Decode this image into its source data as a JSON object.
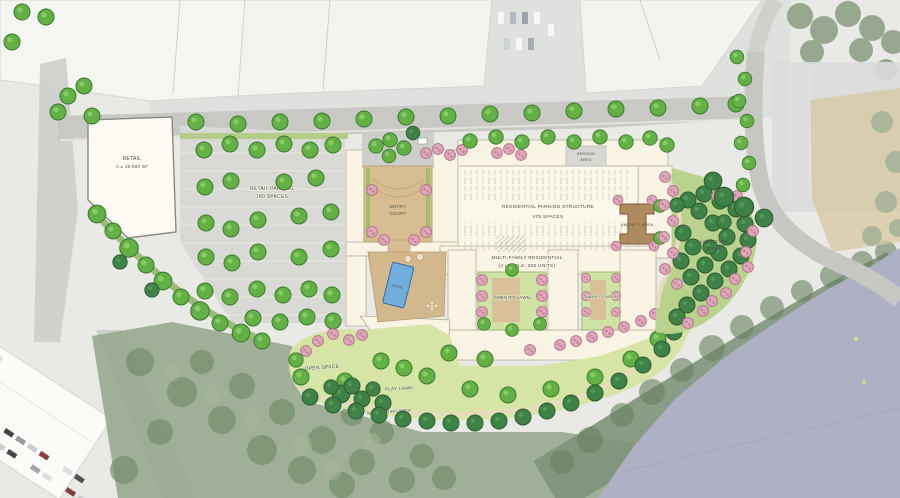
{
  "plan": {
    "labels": {
      "retail_building": [
        "RETAIL",
        "A ± 19,000 SF"
      ],
      "retail_parking": [
        "RETAIL PARKING",
        "180 SPACES"
      ],
      "entry_court": [
        "ENTRY",
        "COURT"
      ],
      "service_area": [
        "SERVICE",
        "AREA"
      ],
      "parking_structure": [
        "RESIDENTIAL PARKING STRUCTURE",
        "475 SPACES"
      ],
      "residential": [
        "MULTI-FAMILY RESIDENTIAL",
        "(4 LEVELS; 325 UNITS)"
      ],
      "pool": "POOL",
      "amenity_area_east": "AMENITY AREA",
      "amenity_lawn": "AMENITY LAWN",
      "amenity_area_court": "AMENITY AREA",
      "landscape_slope": [
        "LANDSCAPE",
        "SLOPE"
      ],
      "open_space": "OPEN SPACE",
      "play_lawn": "PLAY LAWN",
      "meandering_path": "MEANDERING PATH"
    },
    "palette": {
      "site_lawn": "#d6e5a6",
      "canopy_green": "#63b145",
      "canopy_dark": "#3f8247",
      "flowering_pink": "#dfa8ba",
      "building_cream": "#f9f4e3",
      "paving_tan": "#d9bd92",
      "pool_blue": "#72aedd",
      "road_gray": "#c8c9c5",
      "parking_gray": "#d9dad6",
      "water_gray_blue": "#adb1c3",
      "aerial_roof_white": "#f5f5f2",
      "woods_muted": "#95a78d"
    }
  }
}
